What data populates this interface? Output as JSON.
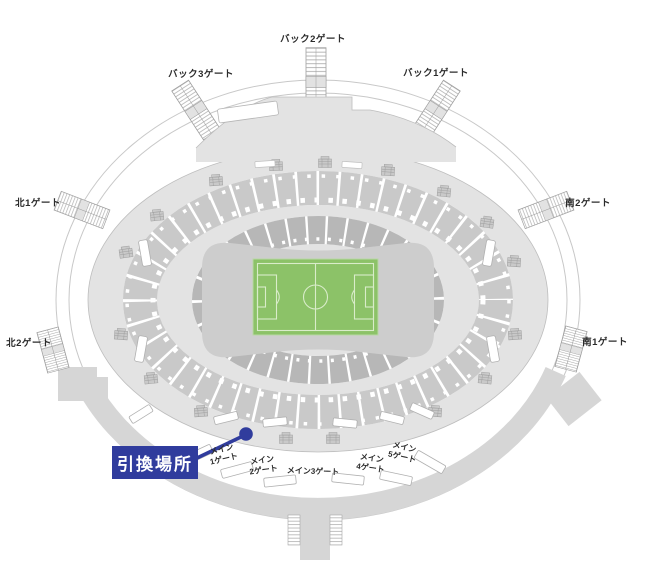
{
  "perimeter_gates": {
    "back2": {
      "label": "バック2ゲート"
    },
    "back3": {
      "label": "バック3ゲート"
    },
    "back1": {
      "label": "バック1ゲート"
    },
    "north1": {
      "label": "北1ゲート"
    },
    "south2": {
      "label": "南2ゲート"
    },
    "north2": {
      "label": "北2ゲート"
    },
    "south1": {
      "label": "南1ゲート"
    }
  },
  "main_gates": {
    "m1": {
      "line1": "メイン",
      "line2": "1ゲート"
    },
    "m2": {
      "line1": "メイン",
      "line2": "2ゲート"
    },
    "m3": {
      "label": "メイン3ゲート"
    },
    "m4": {
      "line1": "メイン",
      "line2": "4ゲート"
    },
    "m5": {
      "line1": "メイン",
      "line2": "5ゲート"
    }
  },
  "marker": {
    "label": "引換場所"
  },
  "colors": {
    "marker_blue": "#303c9d",
    "field_green": "#8cc268",
    "field_line": "#d9ecca",
    "stand_upper_gray": "#c9c9c9",
    "stand_lower_gray": "#b7b7b7",
    "bowl_gray": "#e3e3e3",
    "deck_gray": "#d6d6d6",
    "infield_gray": "#cdcdcd"
  }
}
